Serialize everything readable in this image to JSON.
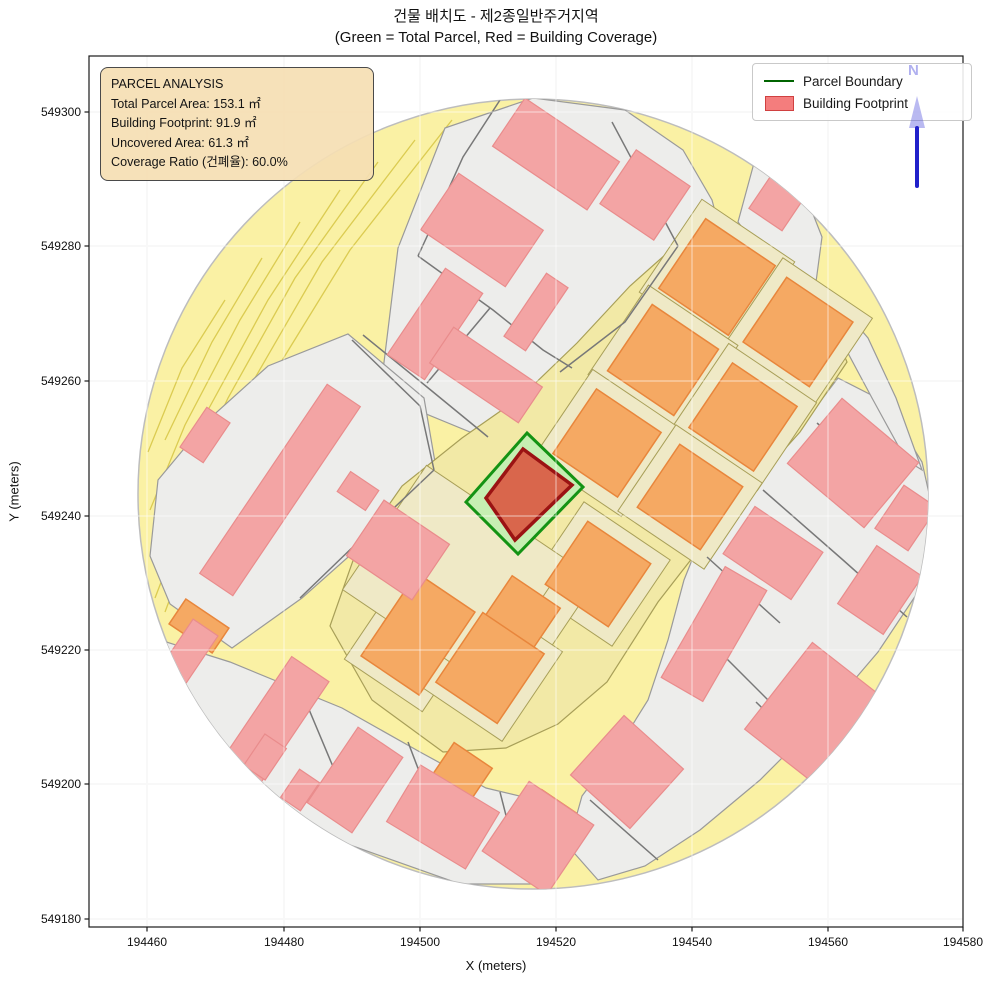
{
  "title": {
    "line1": "건물 배치도 - 제2종일반주거지역",
    "line2": "(Green = Total Parcel, Red = Building Coverage)"
  },
  "annotation": {
    "lines": [
      "PARCEL ANALYSIS",
      "Total Parcel Area: 153.1 ㎡",
      "Building Footprint: 91.9 ㎡",
      "Uncovered Area: 61.3 ㎡",
      "Coverage Ratio (건폐율): 60.0%"
    ]
  },
  "legend": {
    "items": [
      {
        "label": "Parcel Boundary",
        "type": "line"
      },
      {
        "label": "Building Footprint",
        "type": "patch"
      }
    ]
  },
  "north_arrow": {
    "label": "N"
  },
  "axes": {
    "xlabel": "X (meters)",
    "ylabel": "Y (meters)",
    "x_ticks": [
      {
        "label": "194460",
        "px": 147
      },
      {
        "label": "194480",
        "px": 284
      },
      {
        "label": "194500",
        "px": 420
      },
      {
        "label": "194520",
        "px": 556
      },
      {
        "label": "194540",
        "px": 692
      },
      {
        "label": "194560",
        "px": 828
      },
      {
        "label": "194580",
        "px": 963
      }
    ],
    "y_ticks": [
      {
        "label": "549300",
        "px": 112
      },
      {
        "label": "549280",
        "px": 246
      },
      {
        "label": "549260",
        "px": 381
      },
      {
        "label": "549240",
        "px": 516
      },
      {
        "label": "549220",
        "px": 650
      },
      {
        "label": "549200",
        "px": 784
      },
      {
        "label": "549180",
        "px": 919
      }
    ],
    "plot_rect": {
      "left": 89,
      "top": 56,
      "right": 963,
      "bottom": 927
    }
  },
  "colors": {
    "yellow": "#FAF1A4",
    "stripe": "#DBCB51",
    "gray_fill": "#EDEDEB",
    "gray_stroke": "#9A9A9A",
    "road_line": "#787878",
    "band_fill": "#F2E9A6",
    "band_stroke": "#A89F58",
    "cell_fill": "#EFE9C6",
    "cell_stroke": "#A89F58",
    "orange_fill": "#F5A963",
    "orange_stroke": "#E8863C",
    "pink_fill": "#F3A4A4",
    "pink_stroke": "#E98C8C",
    "green_fill": "#C6EFB2",
    "green_stroke": "#149314",
    "red_fill": "#D9664C",
    "red_stroke": "#9B1313",
    "circle_stroke": "#BDBDBD",
    "grid": "#E4E4E4",
    "grid_overlay": "rgba(255,255,255,0.5)",
    "spine": "#1a1a1a",
    "tick_text": "#111111"
  },
  "map": {
    "circle": {
      "cx": 533,
      "cy": 494,
      "r": 395
    },
    "stripes": [
      [
        [
          452,
          120
        ],
        [
          350,
          250
        ],
        [
          270,
          380
        ],
        [
          205,
          505
        ],
        [
          165,
          612
        ]
      ],
      [
        [
          415,
          140
        ],
        [
          322,
          262
        ],
        [
          248,
          390
        ],
        [
          188,
          512
        ],
        [
          155,
          598
        ]
      ],
      [
        [
          378,
          162
        ],
        [
          295,
          278
        ],
        [
          228,
          398
        ],
        [
          172,
          518
        ]
      ],
      [
        [
          340,
          190
        ],
        [
          268,
          300
        ],
        [
          208,
          410
        ],
        [
          160,
          520
        ]
      ],
      [
        [
          300,
          222
        ],
        [
          240,
          320
        ],
        [
          185,
          425
        ],
        [
          150,
          510
        ]
      ],
      [
        [
          262,
          258
        ],
        [
          212,
          342
        ],
        [
          165,
          440
        ]
      ],
      [
        [
          225,
          300
        ],
        [
          182,
          368
        ],
        [
          148,
          452
        ]
      ]
    ],
    "gray_regions": [
      [
        [
          445,
          128
        ],
        [
          533,
          98
        ],
        [
          625,
          110
        ],
        [
          683,
          150
        ],
        [
          712,
          200
        ],
        [
          730,
          268
        ],
        [
          727,
          318
        ],
        [
          640,
          385
        ],
        [
          598,
          408
        ],
        [
          540,
          425
        ],
        [
          470,
          432
        ],
        [
          380,
          395
        ],
        [
          398,
          248
        ]
      ],
      [
        [
          757,
          152
        ],
        [
          802,
          186
        ],
        [
          822,
          237
        ],
        [
          816,
          282
        ],
        [
          768,
          262
        ],
        [
          738,
          222
        ]
      ],
      [
        [
          348,
          334
        ],
        [
          424,
          398
        ],
        [
          436,
          468
        ],
        [
          392,
          518
        ],
        [
          302,
          598
        ],
        [
          232,
          648
        ],
        [
          170,
          604
        ],
        [
          150,
          556
        ],
        [
          158,
          480
        ],
        [
          208,
          420
        ],
        [
          268,
          366
        ]
      ],
      [
        [
          160,
          640
        ],
        [
          230,
          662
        ],
        [
          342,
          708
        ],
        [
          420,
          752
        ],
        [
          486,
          788
        ],
        [
          528,
          798
        ],
        [
          560,
          845
        ],
        [
          545,
          884
        ],
        [
          460,
          884
        ],
        [
          350,
          845
        ],
        [
          250,
          790
        ],
        [
          178,
          712
        ],
        [
          150,
          652
        ]
      ],
      [
        [
          838,
          378
        ],
        [
          885,
          402
        ],
        [
          922,
          462
        ],
        [
          936,
          525
        ],
        [
          918,
          592
        ],
        [
          878,
          652
        ],
        [
          820,
          720
        ],
        [
          760,
          780
        ],
        [
          700,
          830
        ],
        [
          645,
          866
        ],
        [
          598,
          880
        ],
        [
          568,
          846
        ],
        [
          582,
          796
        ],
        [
          618,
          748
        ],
        [
          648,
          700
        ],
        [
          668,
          640
        ],
        [
          684,
          580
        ],
        [
          700,
          540
        ],
        [
          748,
          480
        ],
        [
          800,
          428
        ]
      ],
      [
        [
          832,
          296
        ],
        [
          868,
          338
        ],
        [
          896,
          398
        ],
        [
          922,
          470
        ],
        [
          906,
          460
        ],
        [
          872,
          398
        ],
        [
          842,
          342
        ],
        [
          818,
          308
        ]
      ]
    ],
    "band": [
      [
        693,
        230
      ],
      [
        760,
        272
      ],
      [
        833,
        328
      ],
      [
        847,
        362
      ],
      [
        800,
        432
      ],
      [
        757,
        480
      ],
      [
        700,
        548
      ],
      [
        658,
        602
      ],
      [
        607,
        682
      ],
      [
        558,
        724
      ],
      [
        506,
        748
      ],
      [
        443,
        752
      ],
      [
        372,
        700
      ],
      [
        330,
        626
      ],
      [
        356,
        552
      ],
      [
        402,
        486
      ],
      [
        462,
        438
      ],
      [
        522,
        396
      ],
      [
        577,
        343
      ],
      [
        630,
        286
      ]
    ],
    "beige_cells": [
      {
        "c": [
          717,
          277
        ],
        "w": 112,
        "h": 112,
        "a": 34
      },
      {
        "c": [
          798,
          332
        ],
        "w": 108,
        "h": 106,
        "a": 34
      },
      {
        "c": [
          663,
          360
        ],
        "w": 108,
        "h": 108,
        "a": 34
      },
      {
        "c": [
          743,
          417
        ],
        "w": 106,
        "h": 106,
        "a": 34
      },
      {
        "c": [
          607,
          443
        ],
        "w": 106,
        "h": 106,
        "a": 34
      },
      {
        "c": [
          690,
          497
        ],
        "w": 104,
        "h": 104,
        "a": 34
      },
      {
        "c": [
          598,
          574
        ],
        "w": 104,
        "h": 104,
        "a": 34
      },
      {
        "c": [
          520,
          616
        ],
        "w": 86,
        "h": 86,
        "a": 34
      },
      {
        "c": [
          418,
          634
        ],
        "w": 94,
        "h": 124,
        "a": 34
      },
      {
        "c": [
          490,
          668
        ],
        "w": 102,
        "h": 108,
        "a": 34
      },
      {
        "c": [
          455,
          575
        ],
        "w": 170,
        "h": 150,
        "a": 34
      }
    ],
    "orange_buildings": [
      {
        "c": [
          717,
          277
        ],
        "w": 84,
        "h": 84,
        "a": 34
      },
      {
        "c": [
          798,
          332
        ],
        "w": 80,
        "h": 78,
        "a": 34
      },
      {
        "c": [
          663,
          360
        ],
        "w": 80,
        "h": 80,
        "a": 34
      },
      {
        "c": [
          743,
          417
        ],
        "w": 78,
        "h": 78,
        "a": 34
      },
      {
        "c": [
          607,
          443
        ],
        "w": 78,
        "h": 78,
        "a": 34
      },
      {
        "c": [
          690,
          497
        ],
        "w": 76,
        "h": 76,
        "a": 34
      },
      {
        "c": [
          598,
          574
        ],
        "w": 76,
        "h": 76,
        "a": 34
      },
      {
        "c": [
          520,
          616
        ],
        "w": 58,
        "h": 58,
        "a": 34
      },
      {
        "c": [
          418,
          634
        ],
        "w": 70,
        "h": 100,
        "a": 34
      },
      {
        "c": [
          490,
          668
        ],
        "w": 74,
        "h": 84,
        "a": 34
      },
      {
        "c": [
          199,
          626
        ],
        "w": 52,
        "h": 30,
        "a": 34
      },
      {
        "c": [
          462,
          772
        ],
        "w": 46,
        "h": 40,
        "a": 34
      },
      {
        "c": [
          548,
          818
        ],
        "w": 42,
        "h": 40,
        "a": 34
      }
    ],
    "road_lines": [
      [
        [
          500,
          100
        ],
        [
          463,
          157
        ],
        [
          430,
          230
        ],
        [
          418,
          256
        ]
      ],
      [
        [
          418,
          256
        ],
        [
          493,
          310
        ],
        [
          543,
          350
        ],
        [
          572,
          368
        ]
      ],
      [
        [
          363,
          335
        ],
        [
          427,
          387
        ],
        [
          488,
          437
        ]
      ],
      [
        [
          490,
          308
        ],
        [
          427,
          383
        ]
      ],
      [
        [
          612,
          122
        ],
        [
          678,
          246
        ]
      ],
      [
        [
          678,
          246
        ],
        [
          625,
          322
        ],
        [
          560,
          372
        ]
      ],
      [
        [
          352,
          340
        ],
        [
          420,
          406
        ],
        [
          434,
          470
        ]
      ],
      [
        [
          434,
          470
        ],
        [
          358,
          542
        ],
        [
          300,
          598
        ]
      ],
      [
        [
          300,
          688
        ],
        [
          352,
          812
        ]
      ],
      [
        [
          408,
          742
        ],
        [
          452,
          858
        ]
      ],
      [
        [
          500,
          792
        ],
        [
          522,
          878
        ]
      ],
      [
        [
          817,
          423
        ],
        [
          893,
          490
        ]
      ],
      [
        [
          763,
          490
        ],
        [
          843,
          560
        ],
        [
          907,
          617
        ]
      ],
      [
        [
          707,
          557
        ],
        [
          780,
          623
        ]
      ],
      [
        [
          698,
          630
        ],
        [
          768,
          700
        ]
      ],
      [
        [
          756,
          702
        ],
        [
          818,
          762
        ]
      ],
      [
        [
          590,
          800
        ],
        [
          658,
          860
        ]
      ]
    ],
    "pink_buildings": [
      {
        "c": [
          556,
          154
        ],
        "w": 114,
        "h": 58,
        "a": 34
      },
      {
        "c": [
          645,
          195
        ],
        "w": 65,
        "h": 65,
        "a": 34
      },
      {
        "c": [
          482,
          230
        ],
        "w": 102,
        "h": 68,
        "a": 34
      },
      {
        "c": [
          435,
          324
        ],
        "w": 45,
        "h": 104,
        "a": 34
      },
      {
        "c": [
          486,
          375
        ],
        "w": 107,
        "h": 43,
        "a": 34
      },
      {
        "c": [
          536,
          312
        ],
        "w": 26,
        "h": 76,
        "a": 34
      },
      {
        "c": [
          765,
          130
        ],
        "w": 50,
        "h": 62,
        "a": 34
      },
      {
        "c": [
          780,
          198
        ],
        "w": 40,
        "h": 52,
        "a": 34
      },
      {
        "c": [
          280,
          490
        ],
        "w": 40,
        "h": 228,
        "a": 34
      },
      {
        "c": [
          358,
          491
        ],
        "w": 34,
        "h": 24,
        "a": 34
      },
      {
        "c": [
          205,
          435
        ],
        "w": 28,
        "h": 48,
        "a": 34
      },
      {
        "c": [
          398,
          550
        ],
        "w": 79,
        "h": 67,
        "a": 34
      },
      {
        "c": [
          158,
          698
        ],
        "w": 30,
        "h": 170,
        "a": 34
      },
      {
        "c": [
          274,
          723
        ],
        "w": 45,
        "h": 130,
        "a": 34
      },
      {
        "c": [
          355,
          780
        ],
        "w": 54,
        "h": 91,
        "a": 34
      },
      {
        "c": [
          443,
          817
        ],
        "w": 92,
        "h": 66,
        "a": 31
      },
      {
        "c": [
          538,
          838
        ],
        "w": 78,
        "h": 84,
        "a": 34
      },
      {
        "c": [
          627,
          772
        ],
        "w": 80,
        "h": 80,
        "a": 42
      },
      {
        "c": [
          714,
          634
        ],
        "w": 48,
        "h": 128,
        "a": 30
      },
      {
        "c": [
          812,
          712
        ],
        "w": 85,
        "h": 110,
        "a": 38
      },
      {
        "c": [
          773,
          553
        ],
        "w": 82,
        "h": 57,
        "a": 34
      },
      {
        "c": [
          853,
          463
        ],
        "w": 100,
        "h": 85,
        "a": 40
      },
      {
        "c": [
          880,
          590
        ],
        "w": 55,
        "h": 70,
        "a": 34
      },
      {
        "c": [
          906,
          518
        ],
        "w": 40,
        "h": 52,
        "a": 34
      },
      {
        "c": [
          265,
          757
        ],
        "w": 26,
        "h": 38,
        "a": 34
      },
      {
        "c": [
          300,
          790
        ],
        "w": 24,
        "h": 34,
        "a": 34
      }
    ],
    "green_parcel": [
      [
        527,
        433
      ],
      [
        583,
        487
      ],
      [
        518,
        554
      ],
      [
        466,
        502
      ]
    ],
    "red_building": [
      [
        523,
        449
      ],
      [
        572,
        485
      ],
      [
        515,
        540
      ],
      [
        486,
        498
      ]
    ]
  }
}
